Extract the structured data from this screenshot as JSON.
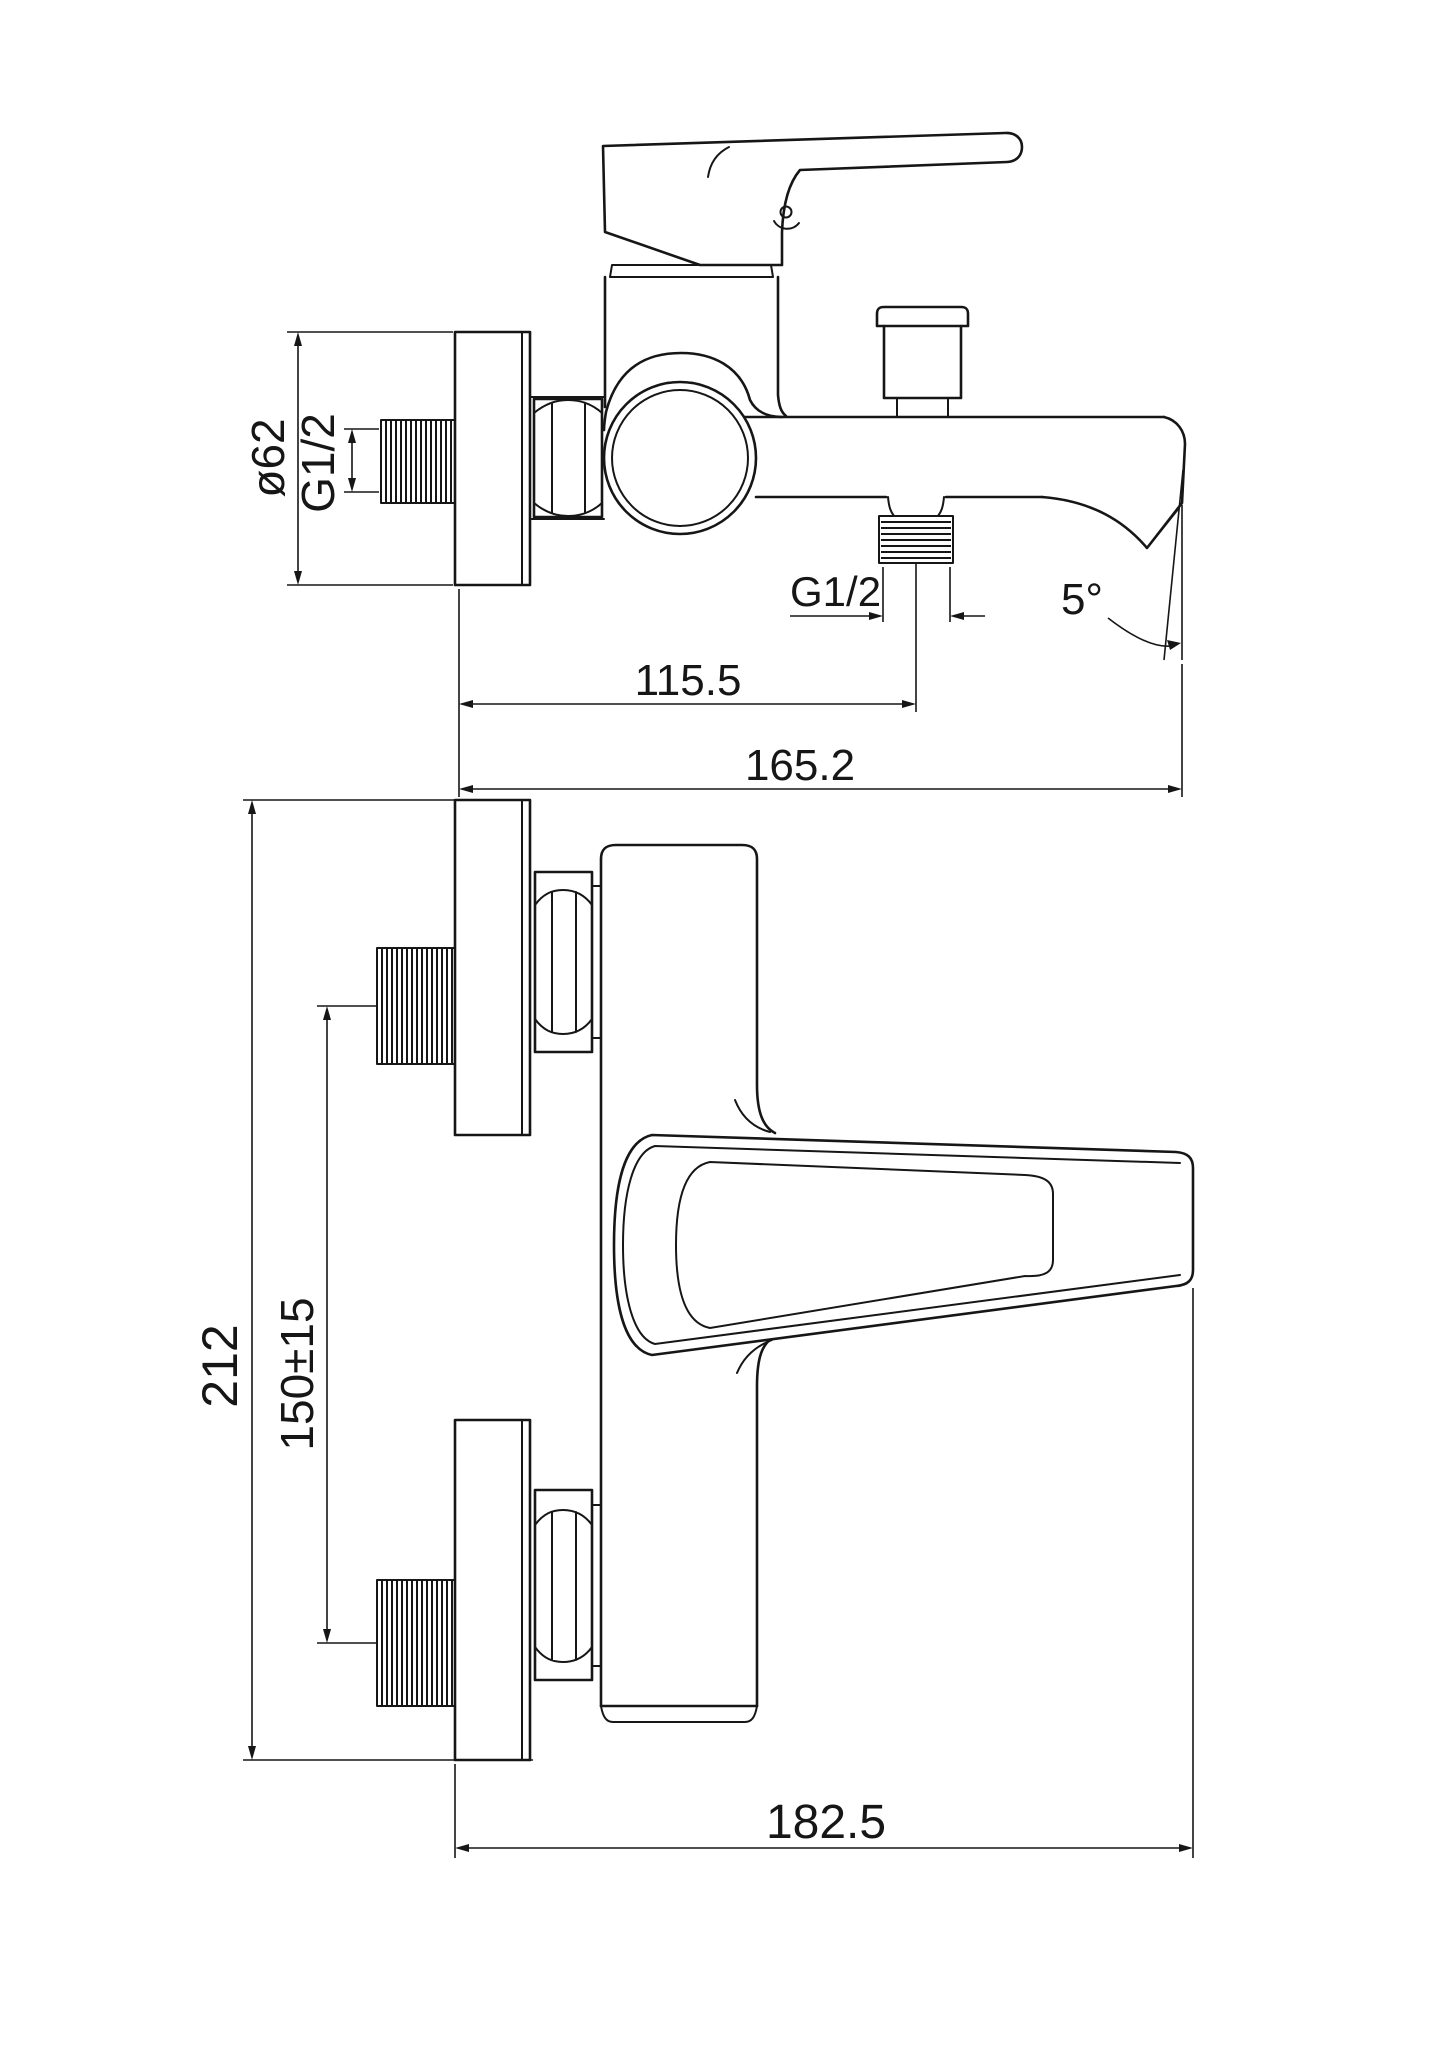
{
  "canvas": {
    "background": "#ffffff",
    "ink": "#161616"
  },
  "drawing": {
    "kind": "technical installation drawing, wall-mounted single-lever bath/shower mixer, two orthographic views, black line art on white",
    "side_view": {
      "dims": {
        "flange_diameter": "ø62",
        "wall_thread": "G1/2",
        "outlet_thread": "G1/2",
        "wall_to_outlet": "115.5",
        "wall_to_spout_tip": "165.2",
        "spout_angle": "5°"
      }
    },
    "front_view": {
      "dims": {
        "overall_height": "212",
        "inlet_spacing": "150±15",
        "overall_depth": "182.5"
      }
    }
  }
}
